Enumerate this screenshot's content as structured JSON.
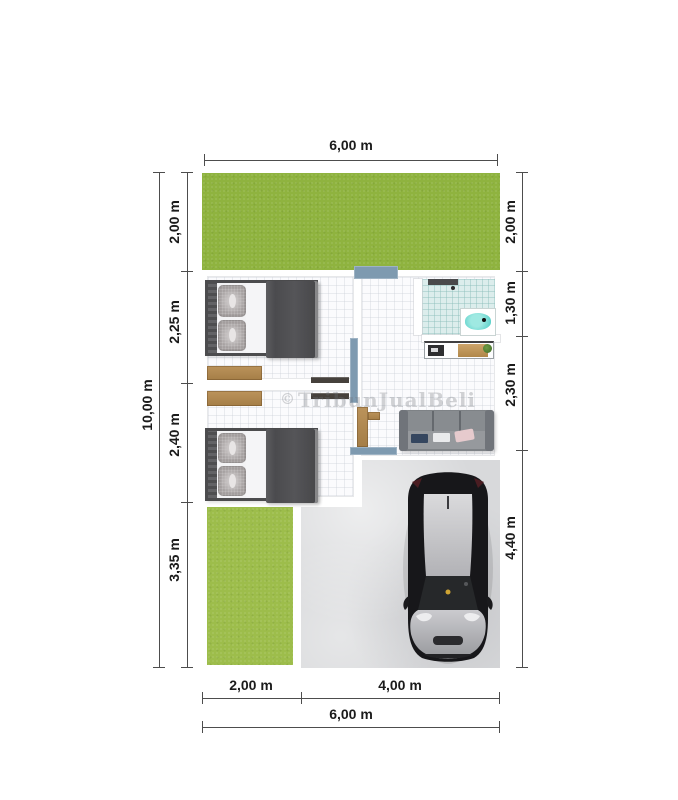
{
  "plan": {
    "type": "floor-plan",
    "total_width_m": 6.0,
    "total_height_m": 10.0
  },
  "dimensions": {
    "top_total": "6,00 m",
    "left_total": "10,00 m",
    "left_segments": [
      "2,00 m",
      "2,25 m",
      "2,40 m",
      "3,35 m"
    ],
    "right_segments": [
      "2,00 m",
      "1,30 m",
      "2,30 m",
      "4,40 m"
    ],
    "bottom_segments": [
      "2,00 m",
      "4,00 m"
    ],
    "bottom_total": "6,00 m"
  },
  "watermark": {
    "symbol": "©",
    "text": "TribunJualBeli"
  },
  "colors": {
    "grass_top": "#8fb33f",
    "grass_bottom": "#9dbd4b",
    "concrete": "#d8d9db",
    "door_accent": "#7e9ab0",
    "bath_tile": "#dcedec",
    "tub_water": "#55cfc8",
    "bed_frame": "#4c4c4e",
    "wood": "#b08749",
    "sofa": "#7e8286",
    "car_body": "#141416",
    "dimension_text": "#1b1b1b"
  }
}
